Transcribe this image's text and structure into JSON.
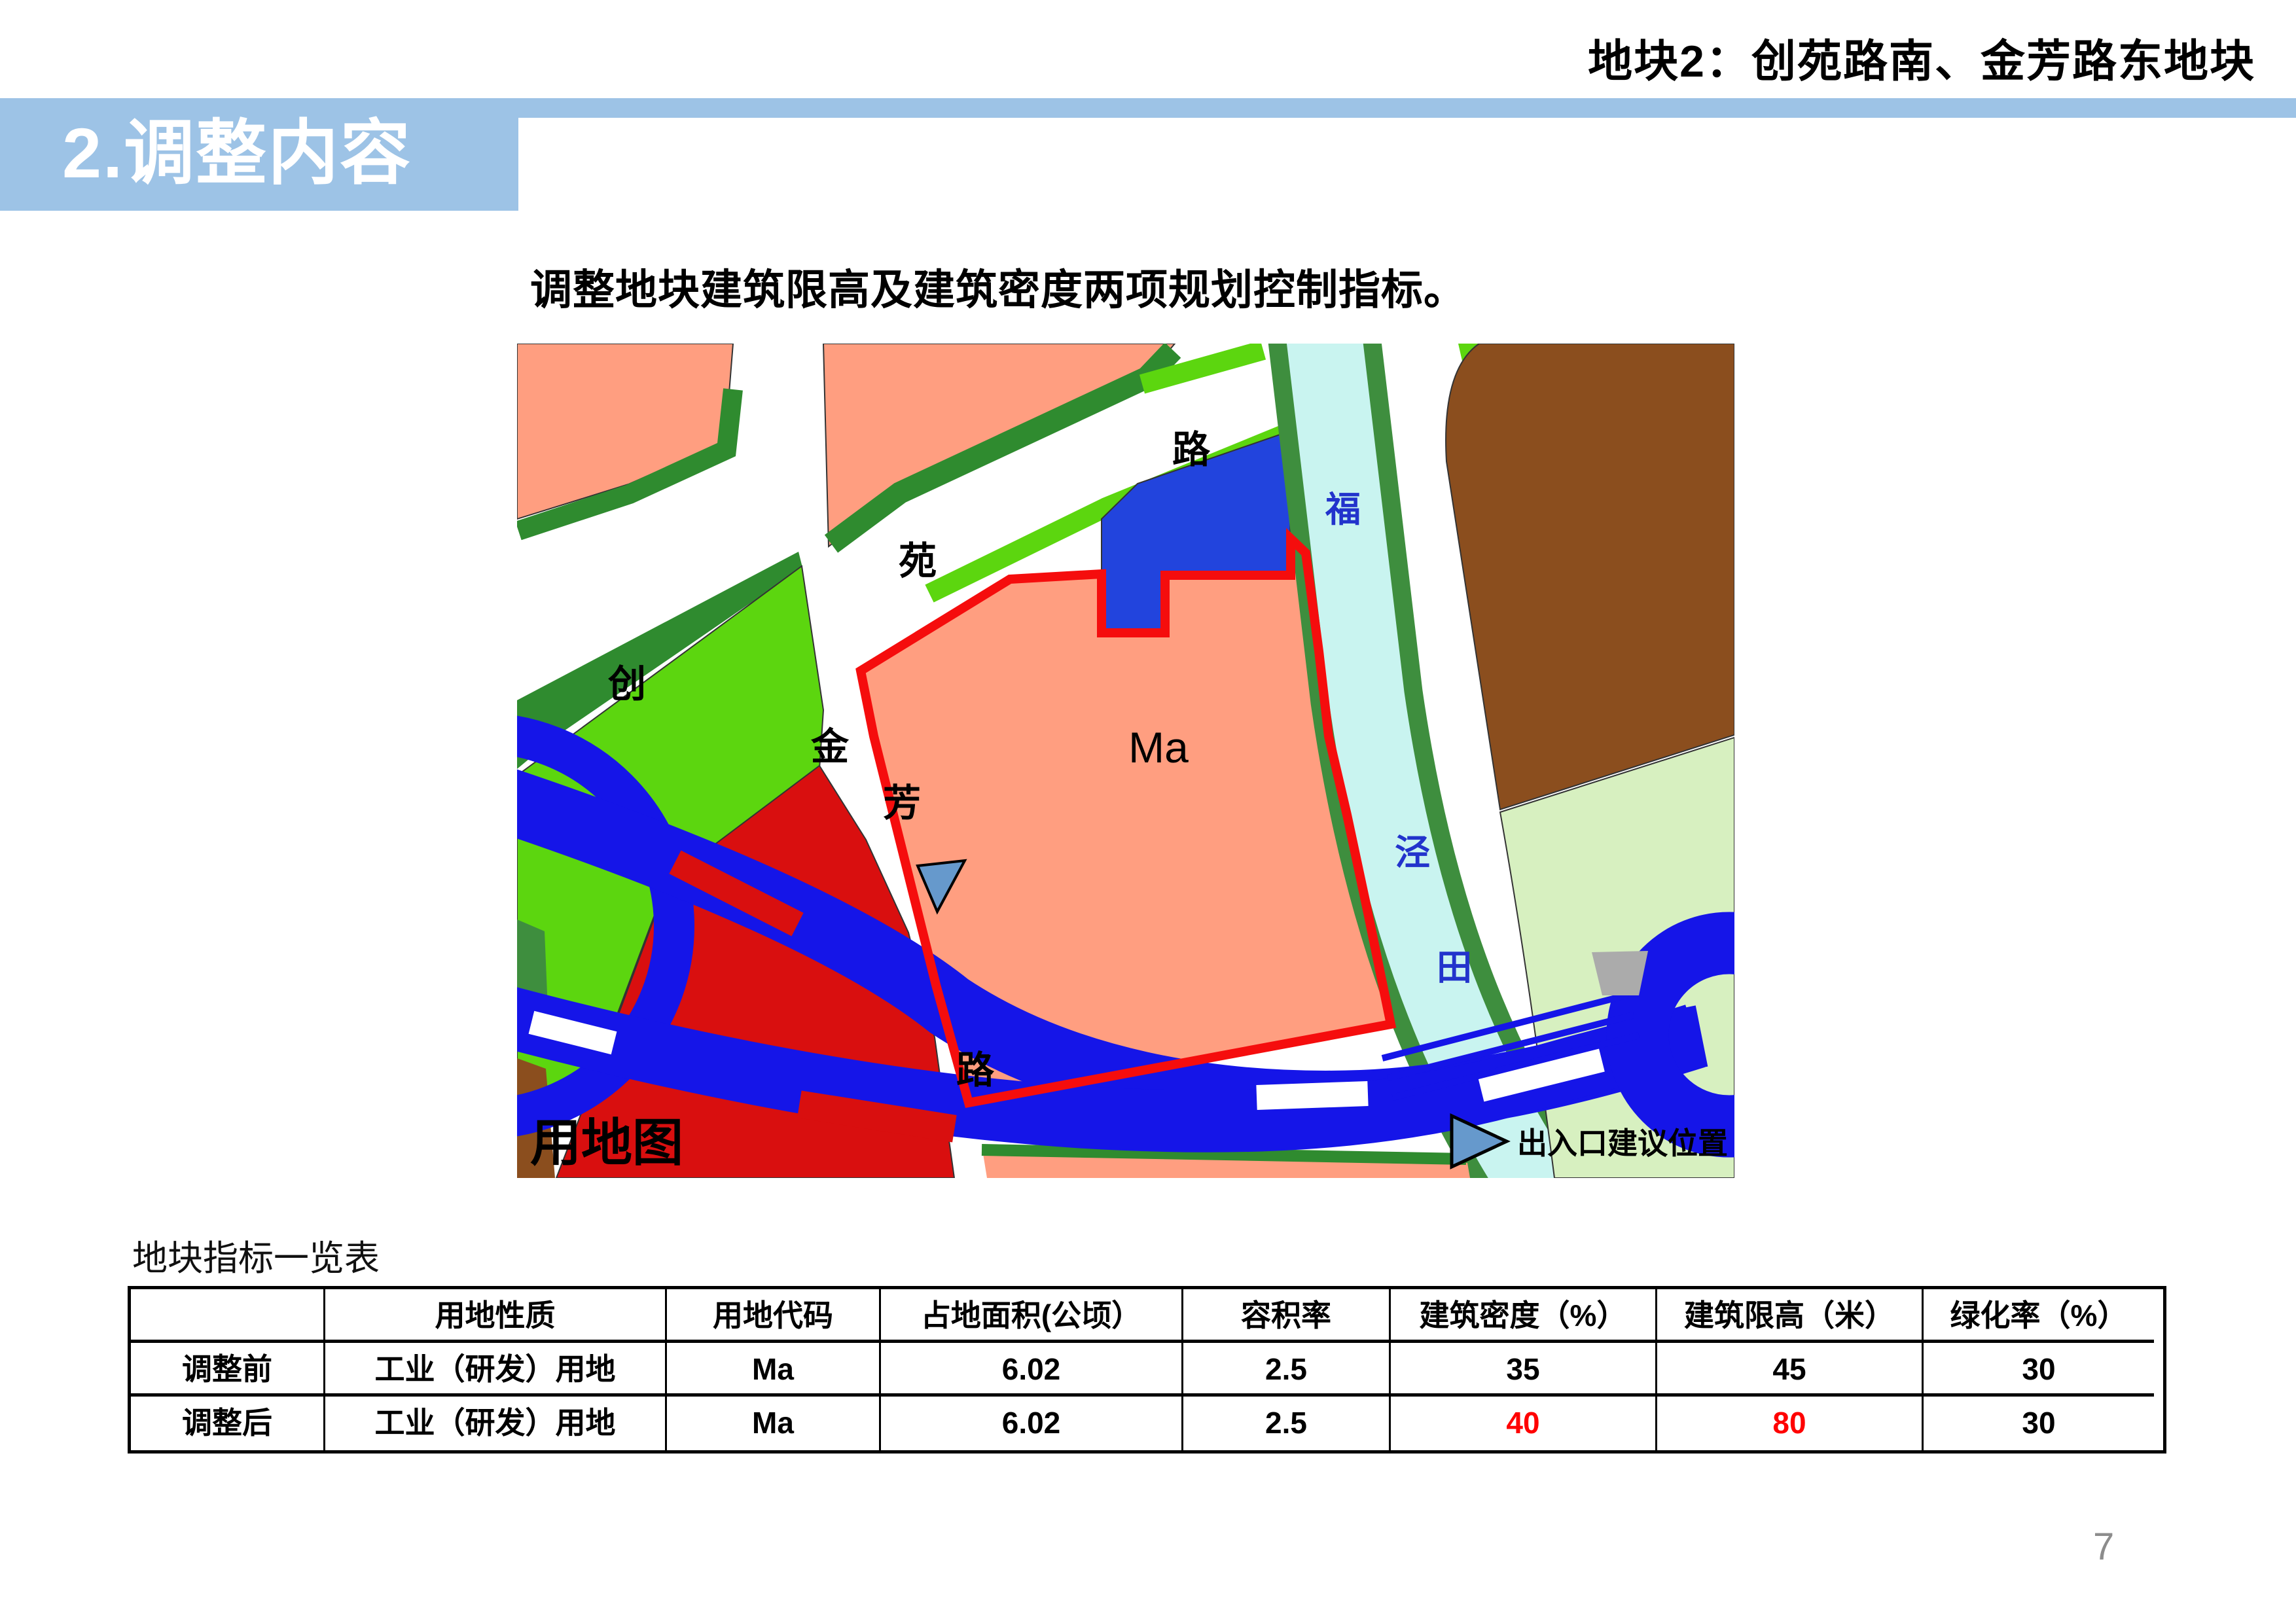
{
  "page": {
    "title": "地块2：创苑路南、金芳路东地块",
    "section_header": "2.调整内容",
    "subtitle": "调整地块建筑限高及建筑密度两项规划控制指标。",
    "page_number": "7"
  },
  "map": {
    "corner_label": "用地图",
    "parcel_label": "Ma",
    "road_labels": {
      "chuang": "创",
      "yuan": "苑",
      "lu_top": "路",
      "jin": "金",
      "fang": "芳",
      "lu_bottom": "路"
    },
    "river_labels": {
      "fu": "福",
      "jing": "泾",
      "tian": "田"
    },
    "legend": {
      "entrance": "出入口建议位置"
    },
    "colors": {
      "salmon_parcel": "#FF9E80",
      "crimson_parcel": "#D90F0F",
      "light_green_parcel": "#5CD60F",
      "dark_green_strip": "#2F8B2F",
      "river_bank_green": "#3E8E3E",
      "river_water": "#C9F4F0",
      "brown_parcel": "#8B4E1E",
      "pale_green_parcel": "#D7F0C0",
      "expressway_blue": "#1515E8",
      "blue_parcel": "#2244DD",
      "boundary_red": "#F50D0D",
      "marker_blue": "#6699CC",
      "band_blue": "#9DC3E6"
    }
  },
  "table": {
    "caption": "地块指标一览表",
    "headers": [
      "",
      "用地性质",
      "用地代码",
      "占地面积(公顷）",
      "容积率",
      "建筑密度（%）",
      "建筑限高（米）",
      "绿化率（%）"
    ],
    "rows": [
      {
        "cells": [
          "调整前",
          "工业（研发）用地",
          "Ma",
          "6.02",
          "2.5",
          "35",
          "45",
          "30"
        ]
      },
      {
        "cells": [
          "调整后",
          "工业（研发）用地",
          "Ma",
          "6.02",
          "2.5",
          "40",
          "80",
          "30"
        ]
      }
    ],
    "highlight_color": "#FF0000"
  }
}
